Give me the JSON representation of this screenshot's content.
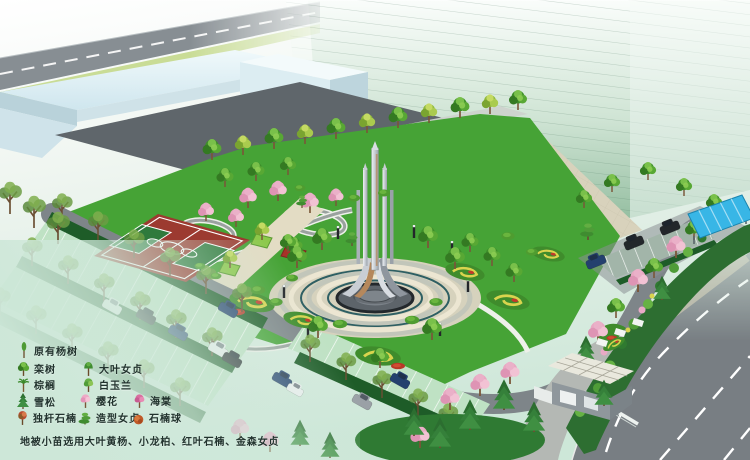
{
  "legend": {
    "items": [
      {
        "icon": "poplar-icon",
        "label": "原有杨树"
      },
      {
        "icon": "goldenrain-tree-icon",
        "label": "栾树"
      },
      {
        "icon": "big-leaf-privet-icon",
        "label": "大叶女贞"
      },
      {
        "icon": "palm-icon",
        "label": "棕榈"
      },
      {
        "icon": "white-magnolia-icon",
        "label": "白玉兰"
      },
      {
        "icon": "cedar-icon",
        "label": "雪松"
      },
      {
        "icon": "cherry-blossom-icon",
        "label": "樱花"
      },
      {
        "icon": "crabapple-icon",
        "label": "海棠"
      },
      {
        "icon": "single-stem-photinia-icon",
        "label": "独杆石楠"
      },
      {
        "icon": "shaped-privet-icon",
        "label": "造型女贞"
      },
      {
        "icon": "photinia-ball-icon",
        "label": "石楠球"
      }
    ],
    "caption": "地被小苗选用大叶黄杨、小龙柏、红叶石楠、金森女贞"
  },
  "colors": {
    "lawn_green": "#46a336",
    "court_red": "#9c3a30",
    "court_key_green": "#2f7a3c",
    "parking_stall_green": "#bfe2c4",
    "asphalt_gray": "#7e8589",
    "main_road_gray": "#787e83",
    "courtyard_gray": "#5f666b",
    "highrise_mint": "#9dc3a8",
    "lowrise_cyan": "#d8ebf1",
    "monument_steel": "#d9dde2",
    "monument_copper": "#b5885c",
    "canopy_blue": "#38b6e6",
    "blossom_pink": "#e8a8c2",
    "flower_yellow": "#d9d44e",
    "flower_red": "#c23a2a",
    "hedge_green": "#c9dc96",
    "legend_text": "#22332e"
  }
}
